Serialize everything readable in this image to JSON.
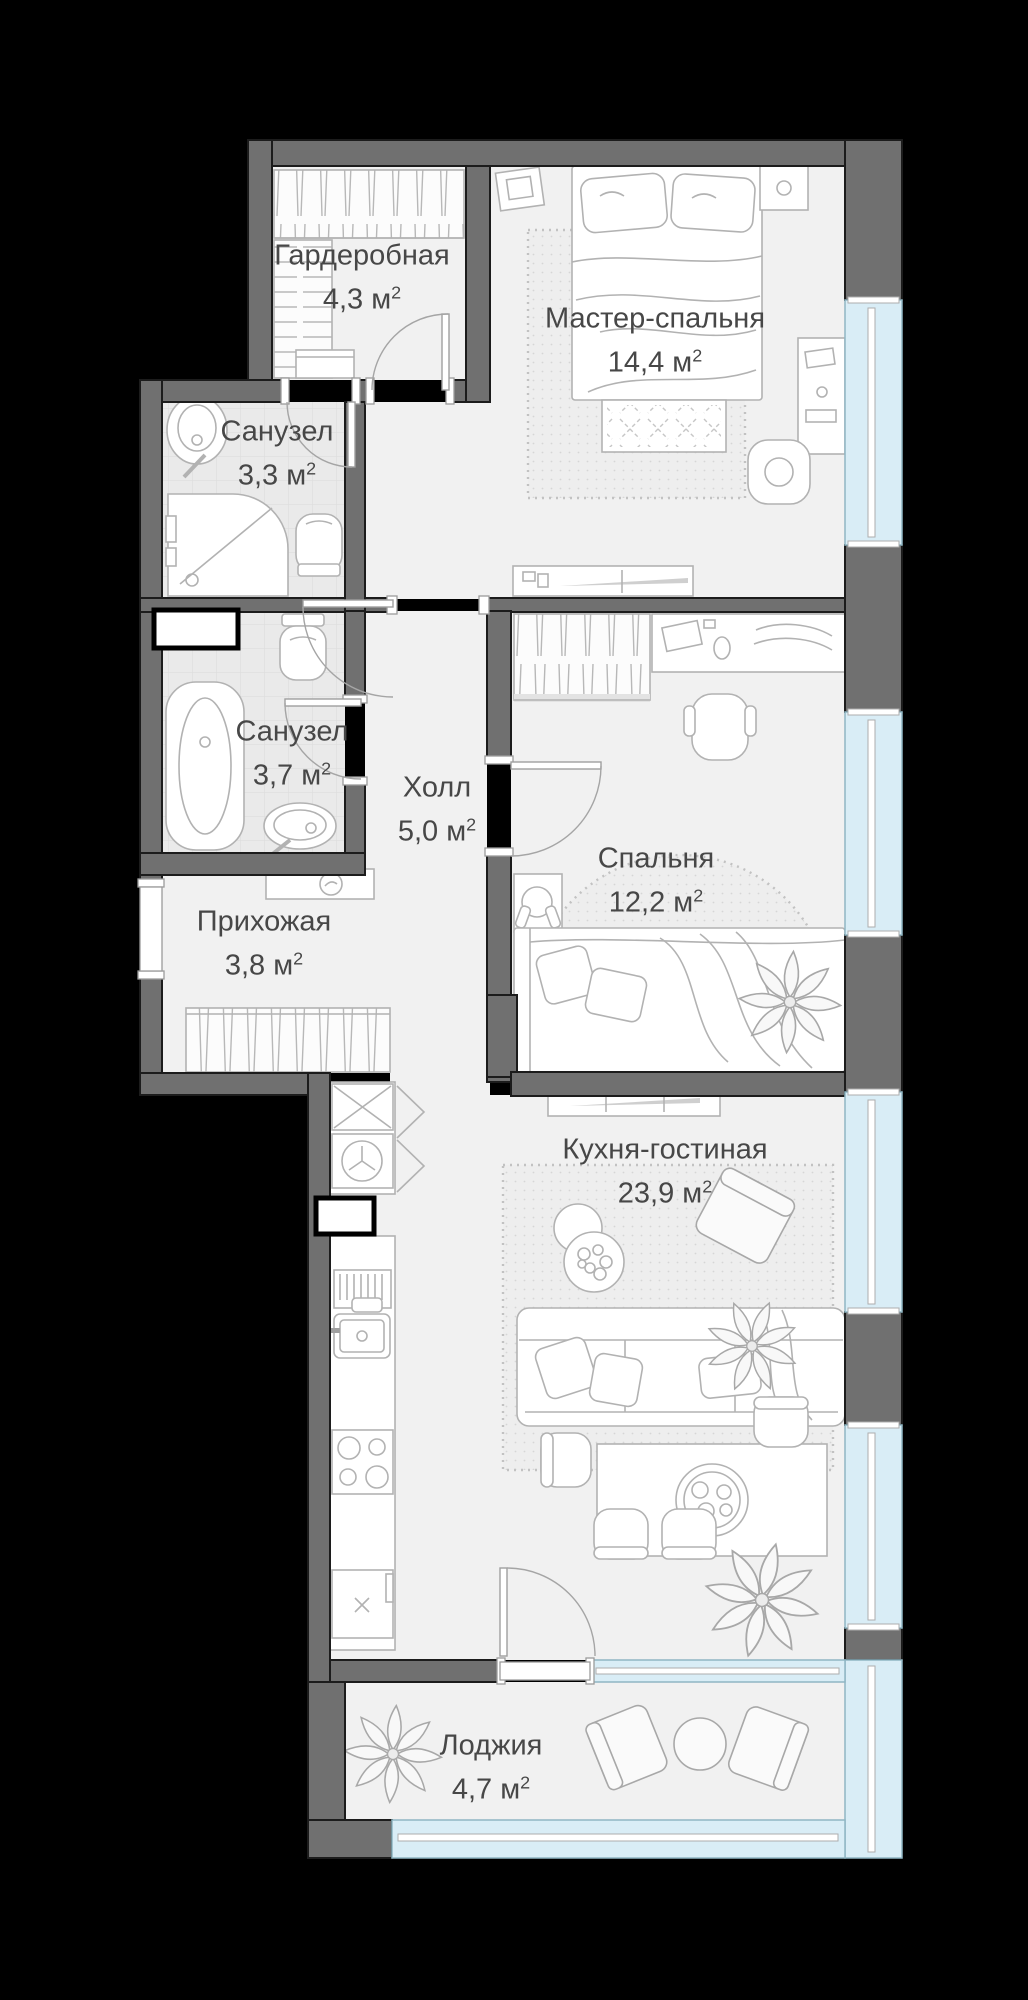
{
  "plan": {
    "units": {
      "m": " м",
      "sup": "2"
    },
    "rooms": [
      {
        "id": "garderobnaya",
        "name": "Гардеробная",
        "area": "4,3",
        "furniture": [
          "clothes-rail",
          "shelving",
          "bench"
        ]
      },
      {
        "id": "master-bedroom",
        "name": "Мастер-спальня",
        "area": "14,4",
        "furniture": [
          "double-bed",
          "nightstand",
          "nightstand",
          "rug",
          "desk",
          "chair",
          "tv-console"
        ]
      },
      {
        "id": "bathroom-1",
        "name": "Санузел",
        "area": "3,3",
        "furniture": [
          "washbasin",
          "shower",
          "toilet"
        ]
      },
      {
        "id": "bathroom-2",
        "name": "Санузел",
        "area": "3,7",
        "furniture": [
          "bathtub",
          "toilet",
          "washbasin"
        ]
      },
      {
        "id": "hall",
        "name": "Холл",
        "area": "5,0",
        "furniture": []
      },
      {
        "id": "prihozhaya",
        "name": "Прихожая",
        "area": "3,8",
        "furniture": [
          "console-mirror",
          "closet"
        ]
      },
      {
        "id": "bedroom",
        "name": "Спальня",
        "area": "12,2",
        "furniture": [
          "wardrobe",
          "desk",
          "office-chair",
          "nightstand-headphones",
          "bed",
          "plant"
        ]
      },
      {
        "id": "kitchen-living",
        "name": "Кухня-гостиная",
        "area": "23,9",
        "furniture": [
          "kitchen-counter",
          "fridge",
          "washing-machine",
          "dish-rack",
          "sink",
          "stove",
          "sofa",
          "coffee-tables",
          "armchair",
          "dining-table",
          "chairs",
          "plants",
          "tv-console"
        ]
      },
      {
        "id": "loggia",
        "name": "Лоджия",
        "area": "4,7",
        "furniture": [
          "plant",
          "chair",
          "round-table",
          "chair"
        ]
      }
    ],
    "colors": {
      "background": "#000000",
      "wall": "#707070",
      "wall_outline": "#1c1c1c",
      "floor": "#f1f1f1",
      "bath_floor": "#eaeaea",
      "window": "#d9edf6",
      "furniture_line": "#b2b2b2",
      "label_text": "#474747"
    }
  }
}
